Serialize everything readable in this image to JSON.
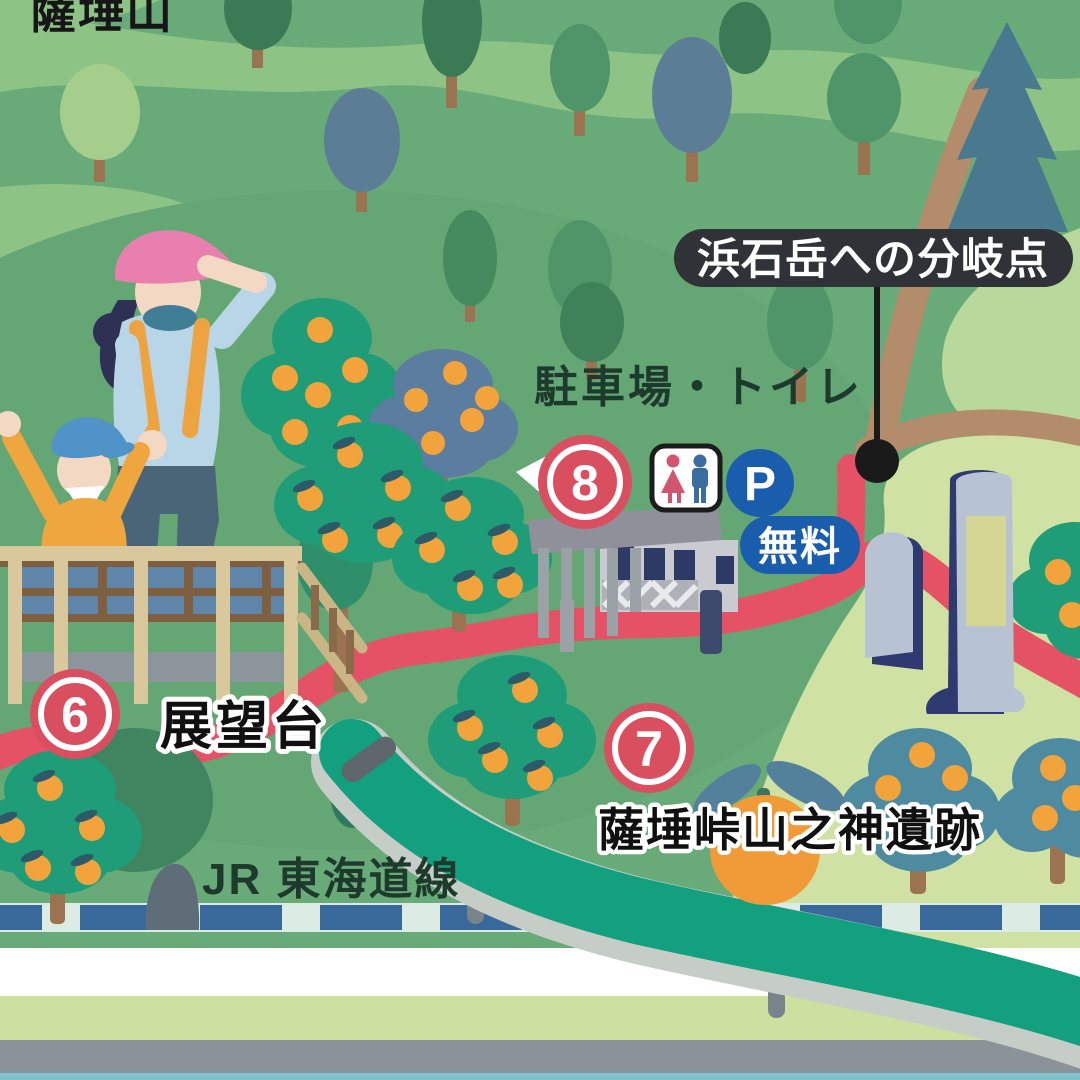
{
  "labels": {
    "mountain": "薩埵山",
    "junction": "浜石岳への分岐点",
    "parking_toilet": "駐車場・トイレ",
    "viewpoint": "展望台",
    "ruins": "薩埵峠山之神遺跡",
    "railway": "JR 東海道線",
    "free": "無料",
    "parking_p": "P"
  },
  "markers": [
    {
      "number": "6",
      "label": "展望台"
    },
    {
      "number": "7",
      "label": "薩埵峠山之神遺跡"
    },
    {
      "number": "8",
      "label": "駐車場・トイレ"
    }
  ],
  "icons": {
    "toilet": "man-woman-toilet-icon",
    "parking": "parking-p-icon"
  },
  "colors": {
    "background_green": "#68ab78",
    "hill_light": "#8ec386",
    "hill_pale": "#cfe2a3",
    "marker_red": "#d94f5f",
    "trail_red": "#e65265",
    "sign_blue": "#1a5dac",
    "expressway_teal": "#12a07e",
    "rail_blue": "#39689a",
    "callout_bg": "#2f3337",
    "mikan_orange": "#f2a33c"
  }
}
